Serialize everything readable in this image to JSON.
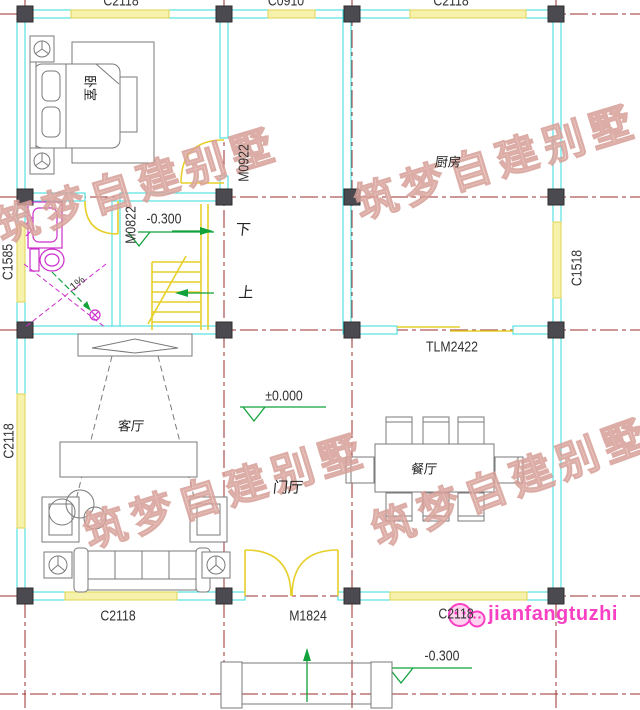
{
  "plan": {
    "rooms": {
      "bedroom": "卧室",
      "kitchen": "厨房",
      "living_room": "客厅",
      "dining_room": "餐厅",
      "foyer": "门厅"
    },
    "openings": {
      "window_top_left": "C2118",
      "window_top_mid": "C0910",
      "window_top_right": "C2118",
      "door_bedroom": "M0922",
      "door_bathroom": "M0822",
      "window_bathroom": "C1585",
      "window_kitchen_right": "C1518",
      "window_living_left": "C2118",
      "door_kitchen_sliding": "TLM2422",
      "window_bottom_left": "C2118",
      "door_entry": "M1824",
      "window_bottom_right": "C2118"
    },
    "elevations": {
      "stair_landing": "-0.300",
      "foyer": "±0.000",
      "exterior": "-0.300"
    },
    "stair_notes": {
      "down": "下",
      "up": "上"
    },
    "slope_note": "1%"
  },
  "watermark": {
    "text": "筑梦自建别墅"
  },
  "logo": {
    "text": "jianfangtuzhi"
  },
  "colors": {
    "grid": "#9c2f2f",
    "wall": "#35dbdb",
    "window": "#f7f2ab",
    "window_edge": "#e0d455",
    "column": "#4a4a50",
    "door": "#e7cf2a",
    "fixture": "#cc2fcc",
    "marker": "#11a23c",
    "furniture": "#7a7a7a",
    "watermark": "#eccbc4",
    "watermark_stroke": "#d79f97",
    "logo": "#f93fc3",
    "text": "#333333"
  }
}
